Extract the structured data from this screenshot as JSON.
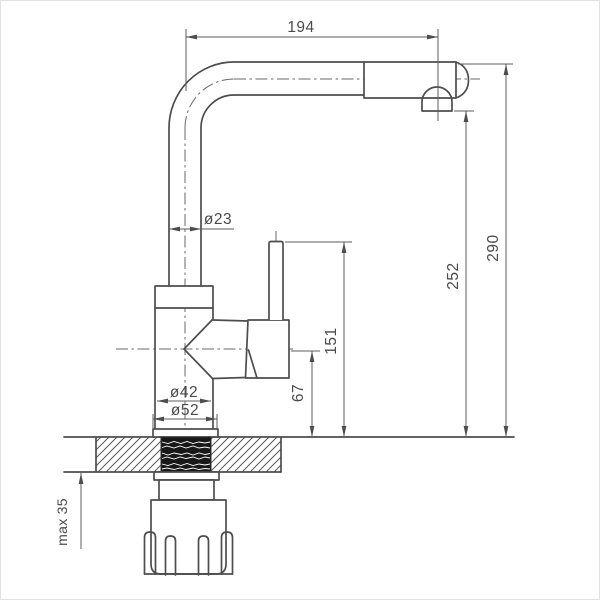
{
  "drawing": {
    "type": "technical-dimension-drawing",
    "subject": "single-lever kitchen faucet, side view with mounting cross-section",
    "units": "mm",
    "colors": {
      "line": "#4d4d4d",
      "thin_line": "#5c5c5c",
      "thread_fill": "#181818",
      "background": "#ffffff"
    },
    "dimensions": {
      "spout_reach": "194",
      "total_height": "290",
      "spout_outlet_height": "252",
      "lever_top_height": "151",
      "body_center_height": "67",
      "spout_tube_diameter": "ø23",
      "body_diameter": "ø42",
      "base_flange_diameter": "ø52",
      "max_deck_thickness": "max 35"
    }
  }
}
